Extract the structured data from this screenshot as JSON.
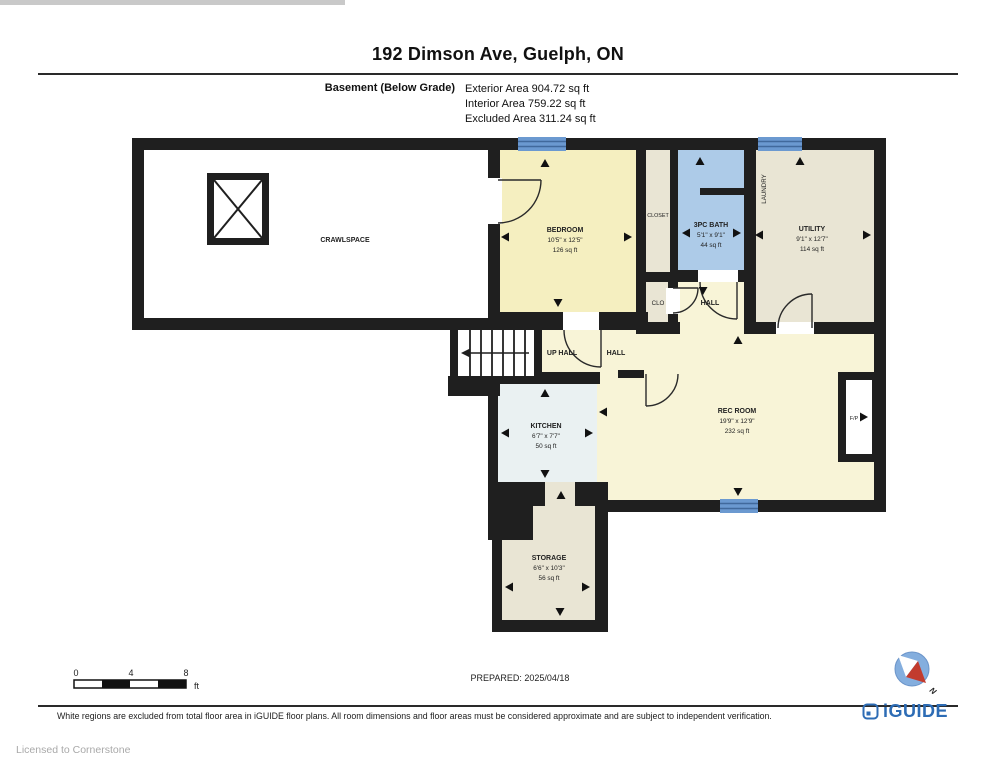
{
  "header": {
    "title": "192 Dimson Ave, Guelph, ON",
    "floor_label": "Basement (Below Grade)",
    "areas": {
      "exterior": "Exterior Area 904.72 sq ft",
      "interior": "Interior Area 759.22 sq ft",
      "excluded": "Excluded Area 311.24 sq ft"
    }
  },
  "rooms": {
    "crawlspace": {
      "name": "CRAWLSPACE"
    },
    "bedroom": {
      "name": "BEDROOM",
      "dims": "10'5\" x 12'5\"",
      "area": "126 sq ft"
    },
    "closet": {
      "name": "CLOSET"
    },
    "clo": {
      "name": "CLO"
    },
    "bath": {
      "name": "3PC BATH",
      "dims": "5'1\" x 9'1\"",
      "area": "44 sq ft"
    },
    "laundry": {
      "name": "LAUNDRY"
    },
    "utility": {
      "name": "UTILITY",
      "dims": "9'1\" x 12'7\"",
      "area": "114 sq ft"
    },
    "hall": {
      "name": "HALL"
    },
    "up_hall": {
      "name": "UP HALL"
    },
    "hall2": {
      "name": "HALL"
    },
    "kitchen": {
      "name": "KITCHEN",
      "dims": "6'7\" x 7'7\"",
      "area": "50 sq ft"
    },
    "rec_room": {
      "name": "REC ROOM",
      "dims": "19'9\" x 12'9\"",
      "area": "232 sq ft"
    },
    "storage": {
      "name": "STORAGE",
      "dims": "6'6\" x 10'3\"",
      "area": "56 sq ft"
    },
    "fireplace": {
      "name": "F/P"
    }
  },
  "scale_bar": {
    "ticks": [
      "0",
      "4",
      "8"
    ],
    "unit": "ft"
  },
  "footer": {
    "prepared": "PREPARED: 2025/04/18",
    "disclaimer": "White regions are excluded from total floor area in iGUIDE floor plans. All room dimensions and floor areas must be considered approximate and are subject to independent verification.",
    "brand": "iGUIDE",
    "licensed": "Licensed to Cornerstone",
    "compass_label": "N"
  },
  "colors": {
    "wall": "#1f1f1f",
    "bedroom_fill": "#f5efc0",
    "cream_fill": "#f8f4d7",
    "bath_fill": "#adcbe8",
    "beige_fill": "#e9e5d4",
    "kitchen_fill": "#eaf1f2",
    "window_blue": "#6b99d0",
    "brand_blue": "#2d6cb5",
    "compass_red": "#c23b2e"
  }
}
